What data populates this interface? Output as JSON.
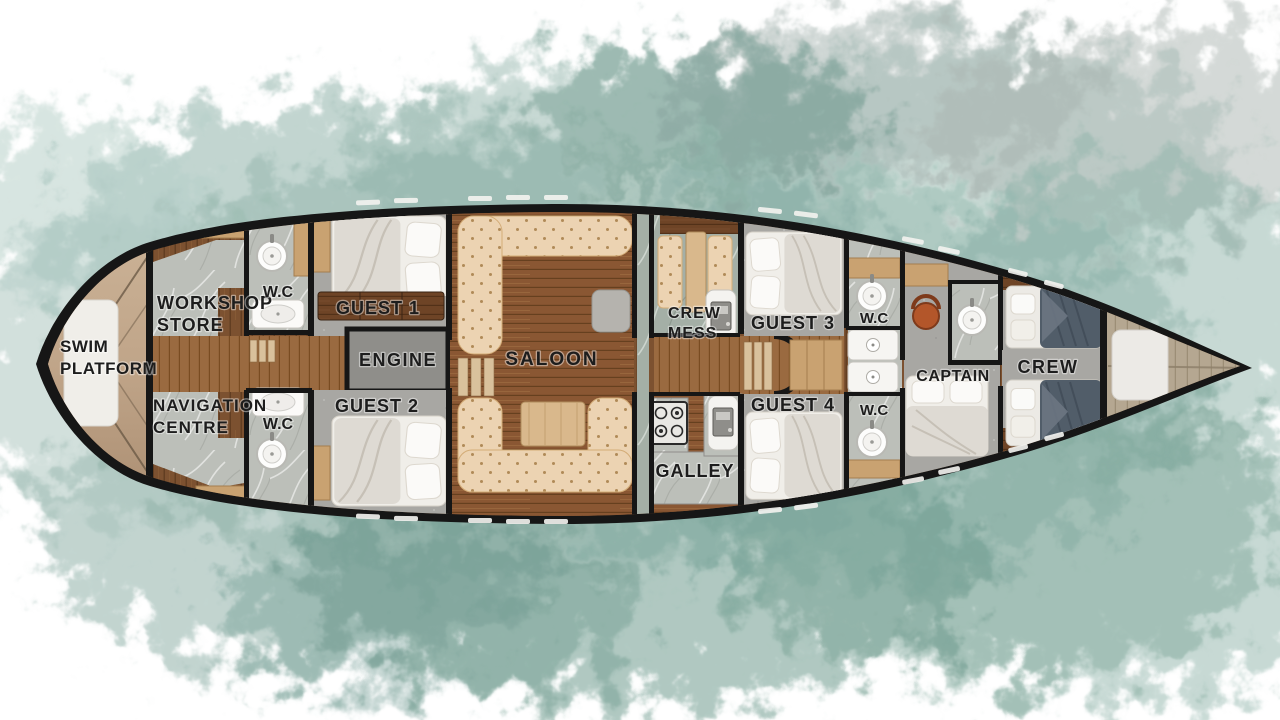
{
  "rooms": {
    "swim_platform": {
      "lines": [
        "SWIM",
        "PLATFORM"
      ]
    },
    "workshop_store": {
      "lines": [
        "WORKSHOP",
        "STORE"
      ]
    },
    "navigation_centre": {
      "lines": [
        "NAVIGATION",
        "CENTRE"
      ]
    },
    "wc_fore_top": {
      "label": "W.C"
    },
    "wc_fore_bottom": {
      "label": "W.C"
    },
    "guest_1": {
      "label": "GUEST 1"
    },
    "engine": {
      "label": "ENGINE"
    },
    "guest_2": {
      "label": "GUEST 2"
    },
    "saloon": {
      "label": "SALOON"
    },
    "crew_mess": {
      "lines": [
        "CREW",
        "MESS"
      ]
    },
    "galley": {
      "label": "GALLEY"
    },
    "guest_3": {
      "label": "GUEST 3"
    },
    "guest_4": {
      "label": "GUEST 4"
    },
    "wc_aft_top": {
      "label": "W.C"
    },
    "wc_aft_bottom": {
      "label": "W.C"
    },
    "captain": {
      "label": "CAPTAIN"
    },
    "crew": {
      "label": "CREW"
    }
  },
  "palette": {
    "hull_black": "#161616",
    "wood_dark": "#6e4426",
    "wood_mid": "#8a5733",
    "wood_light_cabinet": "#c9a271",
    "bow_deck": "#b5a791",
    "marble_gray": "#bcbfb9",
    "marble_green": "#a4afa6",
    "cabin_floor_gray": "#a8a7a3",
    "sofa_tuft": "#ecd3b2",
    "bed_white": "#f0eee9",
    "blanket_navy": "#515d69",
    "chair_orange": "#b3562a",
    "engine_gray": "#8f8e8a",
    "watercolor_teal": "#7fa79c",
    "label_ink": "#1d1d1d"
  }
}
